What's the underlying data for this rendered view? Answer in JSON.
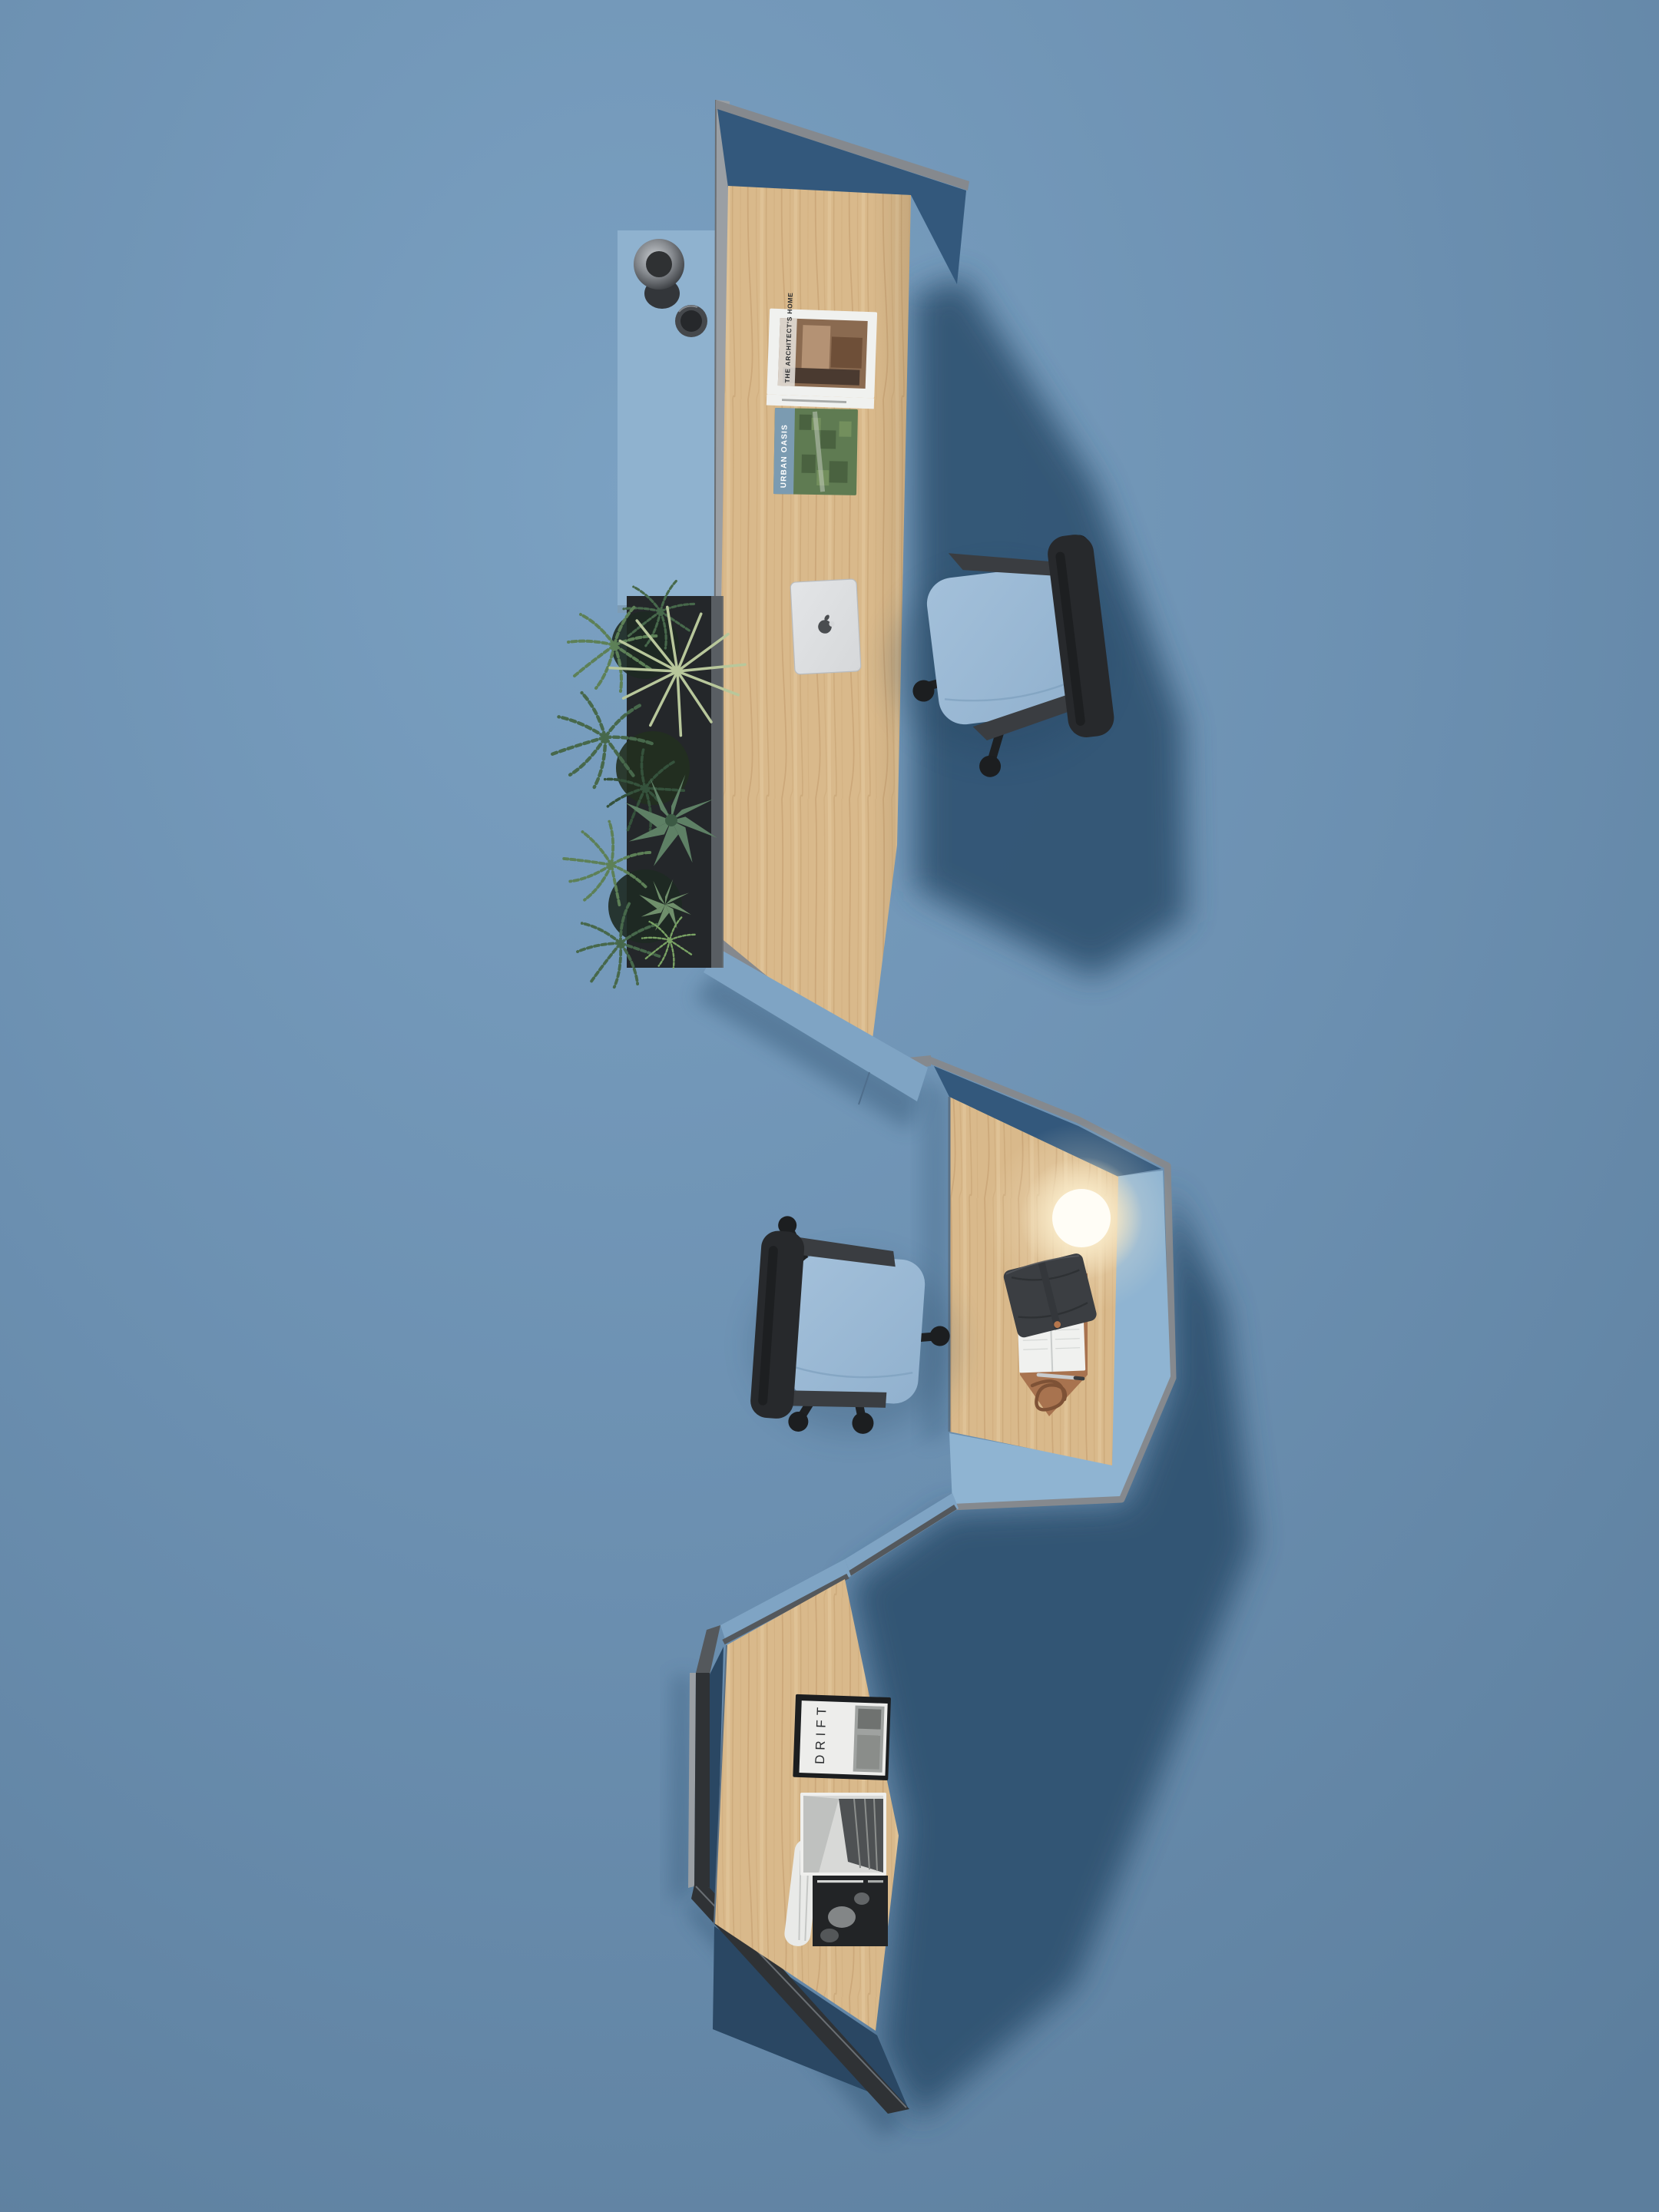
{
  "scene": {
    "kind": "top-down 3d render of a zigzag office desk pod system",
    "background": "#6B8FB0"
  },
  "texts": {
    "magazine_drift": "DRIFT",
    "magazine_urban_oasis": "URBAN OASIS",
    "book_architects_home": "THE ARCHITECT'S HOME"
  },
  "palette": {
    "bg": "#6B8FB0",
    "bgLight": "#7BA1C2",
    "bgDark": "#5C7E9D",
    "shadow": "#2F5170",
    "panelNavy": "#33587C",
    "panelNavyDark": "#2A4763",
    "panelBlue": "#7FA4C4",
    "panelBlueLight": "#8FB4D2",
    "capLight": "#9A9FA4",
    "capMid": "#85898E",
    "capDark": "#54585C",
    "capBlack": "#2F3235",
    "wood": "#D9B98B",
    "woodShade": "#CBA878",
    "woodGrain": "#C09A6B",
    "woodLight": "#E9D4AC",
    "tableBlue": "#8FB2CF",
    "boxDark": "#24272A",
    "chairSeat": "#91B1CE",
    "chairSeatLight": "#A3C0DA",
    "chairDark": "#27292C",
    "chairMid": "#3A3D41",
    "fern": "#47684B",
    "fernDark": "#35523C",
    "fernLight": "#5D8057",
    "fernBright": "#7AA364",
    "leafPale": "#B8C79B",
    "agave": "#5E8065",
    "lampCore": "#FFFDF6",
    "lampGlow": "#F7E7C4",
    "leather": "#A8734F",
    "leatherDark": "#7E5236",
    "journal": "#3B3E42",
    "paper": "#F0F1EF",
    "paperShade": "#D8DAD8",
    "silver": "#D6D8DA",
    "ink": "#2B2D2F",
    "magGreen": "#5F7B52",
    "magStripeBlue": "#7C9DB6",
    "photoGray": "#9FA2A0",
    "darkPage": "#222426"
  },
  "objects": {
    "pods": [
      "top-desk-pod",
      "middle-desk-pod",
      "bottom-desk-pod"
    ],
    "top_pod_items": [
      "blue-side-table",
      "metal-cup",
      "metal-bowl",
      "planter-box",
      "plants",
      "architects-home-book",
      "urban-oasis-magazine",
      "apple-laptop",
      "blue-office-chair"
    ],
    "middle_pod_items": [
      "sphere-lamp",
      "leather-desk-mat",
      "leather-journal",
      "ring-planner",
      "pen",
      "leather-strap",
      "blue-office-chair"
    ],
    "bottom_pod_items": [
      "drift-magazine",
      "open-architecture-magazine"
    ],
    "icons": [
      "apple-logo-icon"
    ]
  }
}
